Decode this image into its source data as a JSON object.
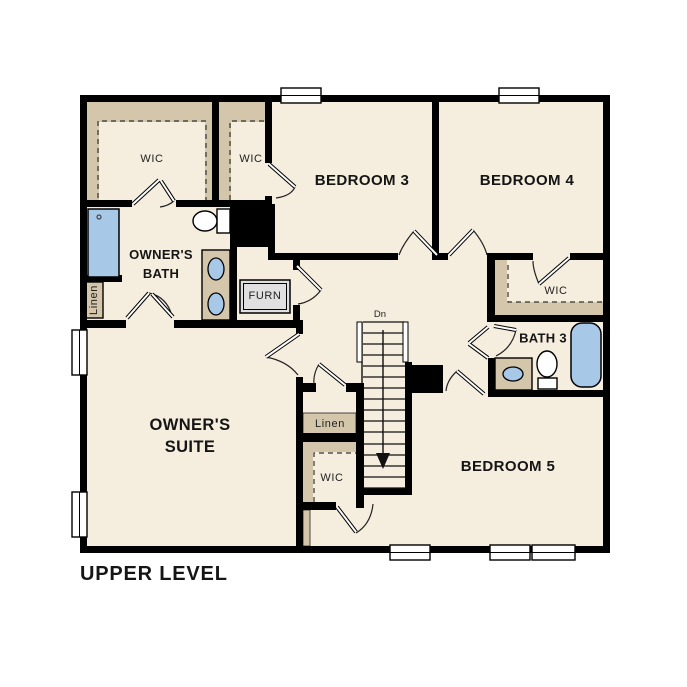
{
  "meta": {
    "type": "floor-plan"
  },
  "colors": {
    "background": "#FFFFFF",
    "wall": "#000000",
    "floor": "#F5EDDE",
    "closet_tan": "#D4C6AB",
    "fixture_blue": "#A8C8E8",
    "furnace_gray": "#E0E0E0"
  },
  "labels": {
    "upper_level": "UPPER LEVEL",
    "owners_wic": "WIC",
    "bedroom3_wic": "WIC",
    "bedroom3": "BEDROOM 3",
    "bedroom4": "BEDROOM 4",
    "bedroom4_wic": "WIC",
    "owners_bath_1": "OWNER'S",
    "owners_bath_2": "BATH",
    "furnace": "FURN",
    "linen_left": "Linen",
    "linen_hall": "Linen",
    "stairs_dn": "Dn",
    "bath3": "BATH 3",
    "hall_wic": "WIC",
    "owners_suite_1": "OWNER'S",
    "owners_suite_2": "SUITE",
    "bedroom5": "BEDROOM 5"
  }
}
